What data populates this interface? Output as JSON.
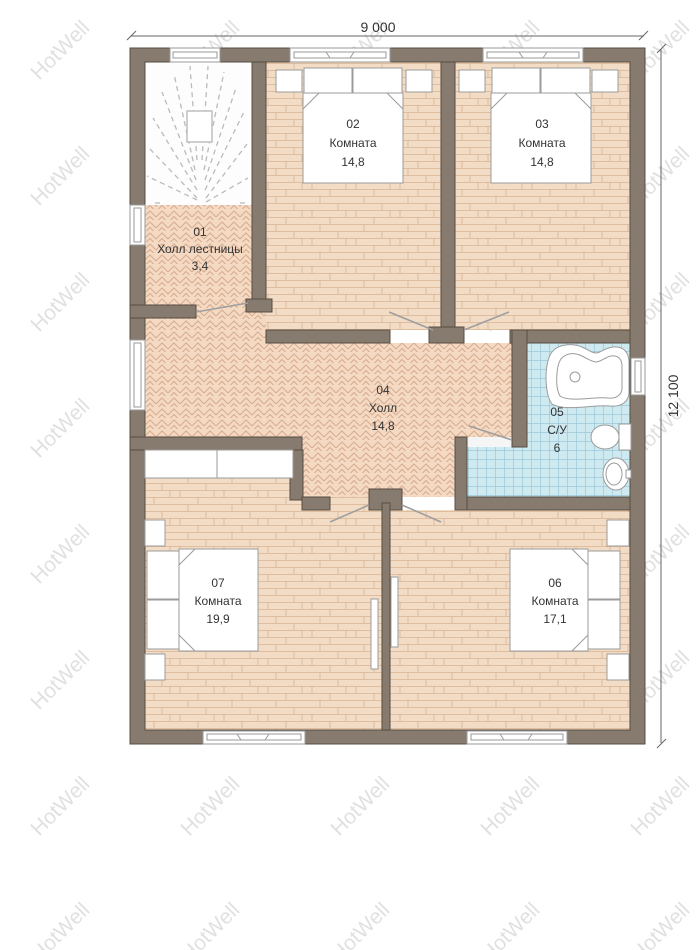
{
  "watermark": {
    "text": "HotWell"
  },
  "dimensions": {
    "width_label": "9 000",
    "height_label": "12 100"
  },
  "rooms": [
    {
      "number": "01",
      "name": "Холл лестницы",
      "area": "3,4"
    },
    {
      "number": "02",
      "name": "Комната",
      "area": "14,8"
    },
    {
      "number": "03",
      "name": "Комната",
      "area": "14,8"
    },
    {
      "number": "04",
      "name": "Холл",
      "area": "14,8"
    },
    {
      "number": "05",
      "name": "С/У",
      "area": "6"
    },
    {
      "number": "06",
      "name": "Комната",
      "area": "17,1"
    },
    {
      "number": "07",
      "name": "Комната",
      "area": "19,9"
    }
  ],
  "colors": {
    "wall": "#877b6f",
    "wall_outline": "#574c42",
    "plank_floor": "#f3dcc6",
    "plank_line": "#d9b493",
    "herringbone_floor": "#f4d9c3",
    "herringbone_line": "#d8ab8e",
    "tile_floor": "#cfe9f1",
    "tile_line": "#9cc8d8",
    "text": "#333333",
    "watermark": "#8a8a8a",
    "furniture_outline": "#9b9b9b",
    "stair_dash": "#bbbbbb",
    "dimension_line": "#666666"
  }
}
